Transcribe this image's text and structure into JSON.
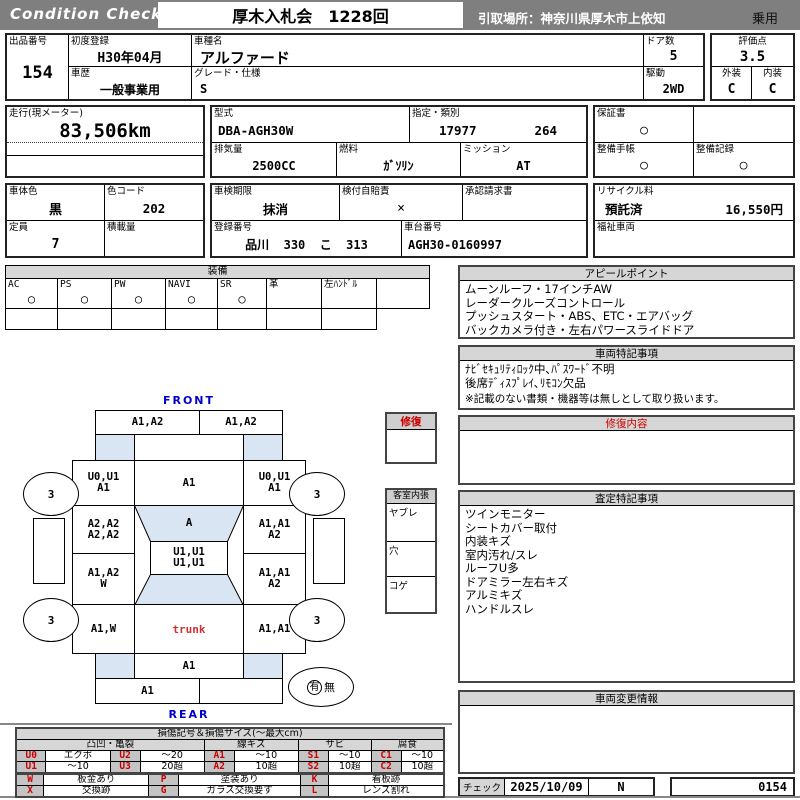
{
  "header": {
    "logo": "Condition  Check",
    "auction_title": "厚木入札会　1228回",
    "pickup": "引取場所：神奈川県厚木市上依知",
    "vehicle_class": "乗用"
  },
  "vehicle": {
    "lot_label": "出品番号",
    "lot_no": "154",
    "first_reg_label": "初度登録",
    "first_reg": "H30年04月",
    "model_label": "車種名",
    "model": "アルファード",
    "doors_label": "ドア数",
    "doors": "5",
    "score_label": "評価点",
    "score": "3.5",
    "history_label": "車歴",
    "history": "一般事業用",
    "grade_label": "グレード・仕様",
    "grade": "S",
    "drive_label": "駆動",
    "drive": "2WD",
    "ext_label": "外装",
    "ext": "C",
    "int_label": "内装",
    "int": "C",
    "mileage_label": "走行(現メーター)",
    "mileage": "83,506km",
    "model_code_label": "型式",
    "model_code": "DBA-AGH30W",
    "class_label": "指定・類別",
    "class1": "17977",
    "class2": "264",
    "warranty_label": "保証書",
    "warranty": "○",
    "disp_label": "排気量",
    "disp": "2500CC",
    "fuel_label": "燃料",
    "fuel": "ｶﾞｿﾘﾝ",
    "trans_label": "ミッション",
    "trans": "AT",
    "book_label": "整備手帳",
    "book": "○",
    "record_label": "整備記録",
    "record": "○",
    "body_color_label": "車体色",
    "body_color": "黒",
    "color_code_label": "色コード",
    "color_code": "202",
    "inspect_label": "車検期限",
    "inspect": "抹消",
    "insurance_label": "検付自賠責",
    "insurance": "×",
    "approval_label": "承認請求書",
    "approval": "",
    "recycle_label": "リサイクル料",
    "recycle_status": "預託済",
    "recycle_fee": "16,550円",
    "capacity_label": "定員",
    "capacity": "7",
    "load_label": "積載量",
    "load": "",
    "reg_label": "登録番号",
    "reg_no": "品川  330  こ  313",
    "chassis_label": "車台番号",
    "chassis": "AGH30-0160997",
    "welfare_label": "福祉車両",
    "welfare": ""
  },
  "equipment": {
    "title": "装備",
    "items": [
      {
        "label": "AC",
        "mark": "○"
      },
      {
        "label": "PS",
        "mark": "○"
      },
      {
        "label": "PW",
        "mark": "○"
      },
      {
        "label": "NAVI",
        "mark": "○"
      },
      {
        "label": "SR",
        "mark": "○"
      },
      {
        "label": "革",
        "mark": ""
      },
      {
        "label": "左ﾊﾝﾄﾞﾙ",
        "mark": ""
      },
      {
        "label": "",
        "mark": ""
      }
    ]
  },
  "appeal": {
    "title": "アピールポイント",
    "lines": [
      "ムーンルーフ・17インチAW",
      "レーダークルーズコントロール",
      "プッシュスタート・ABS、ETC・エアバッグ",
      "バックカメラ付き・左右パワースライドドア"
    ]
  },
  "vehicle_notes": {
    "title": "車両特記事項",
    "lines": [
      "ﾅﾋﾞｾｷｭﾘﾃｨﾛｯｸ中､ﾊﾟｽﾜｰﾄﾞ不明",
      "後席ﾃﾞｨｽﾌﾟﾚｲ､ﾘﾓｺﾝ欠品"
    ],
    "disclaimer": "※記載のない書類・機器等は無しとして取り扱います。"
  },
  "repair": {
    "title": "修復内容",
    "content": ""
  },
  "assessment": {
    "title": "査定特記事項",
    "lines": [
      "ツインモニター",
      "シートカバー取付",
      "内装キズ",
      "室内汚れ/スレ",
      "ルーフU多",
      "ドアミラー左右キズ",
      "アルミキズ",
      "ハンドルスレ"
    ]
  },
  "change_info": {
    "title": "車両変更情報",
    "content": ""
  },
  "check": {
    "label": "チェック",
    "date": "2025/10/09",
    "inspector": "N",
    "sheet_no": "0154"
  },
  "diagram": {
    "front_label": "FRONT",
    "rear_label": "REAR",
    "panels": {
      "front_bumper_l": [
        "A1,A2"
      ],
      "front_bumper_r": [
        "A1,A2"
      ],
      "fender_fl": [
        "U0,U1",
        "A1"
      ],
      "hood": [
        "A1"
      ],
      "fender_fr": [
        "U0,U1",
        "A1"
      ],
      "door_fl": [
        "A2,A2",
        "A2,A2"
      ],
      "windshield": [
        "A"
      ],
      "door_fr": [
        "A1,A1",
        "A2"
      ],
      "roof": [
        "U1,U1",
        "U1,U1"
      ],
      "door_rl": [
        "A1,A2",
        "W"
      ],
      "door_rr": [
        "A1,A1",
        "A2"
      ],
      "quarter_l": [
        "A1,W"
      ],
      "trunk": [
        "trunk"
      ],
      "quarter_r": [
        "A1,A1"
      ],
      "rear_panel": [
        "A1"
      ],
      "rear_bumper_l": [
        "A1"
      ]
    },
    "tires": {
      "fl": "3",
      "fr": "3",
      "rl": "3",
      "rr": "3"
    },
    "spare": {
      "present": "有",
      "absent": "無"
    },
    "repair_legend_title": "修復",
    "interior_legend": {
      "title": "客室内張",
      "rows": [
        "ヤブレ",
        "穴",
        "コゲ"
      ]
    }
  },
  "damage_legend": {
    "title": "損傷記号＆損傷サイズ(～最大cm)",
    "groups": [
      "凸凹・亀裂",
      "線キズ",
      "サビ",
      "腐食"
    ],
    "rows": [
      [
        {
          "code": "U0",
          "desc": "エクボ"
        },
        {
          "code": "U2",
          "desc": "～20"
        },
        {
          "code": "A1",
          "desc": "～10"
        },
        {
          "code": "S1",
          "desc": "～10"
        },
        {
          "code": "C1",
          "desc": "～10"
        }
      ],
      [
        {
          "code": "U1",
          "desc": "～10"
        },
        {
          "code": "U3",
          "desc": "20超"
        },
        {
          "code": "A2",
          "desc": "10超"
        },
        {
          "code": "S2",
          "desc": "10超"
        },
        {
          "code": "C2",
          "desc": "10超"
        }
      ],
      [
        {
          "code": "W",
          "desc": "板金あり"
        },
        {
          "code": "P",
          "desc": "塗装あり"
        },
        {
          "code": "K",
          "desc": "看板跡"
        }
      ],
      [
        {
          "code": "X",
          "desc": "交換跡"
        },
        {
          "code": "G",
          "desc": "ガラス交換要す"
        },
        {
          "code": "L",
          "desc": "レンズ割れ"
        }
      ]
    ]
  },
  "colors": {
    "bar_gray": "#7f7f7f",
    "accent_red": "#cc0000",
    "label_blue": "#0000cc",
    "glass_blue": "#d9e5f2"
  }
}
